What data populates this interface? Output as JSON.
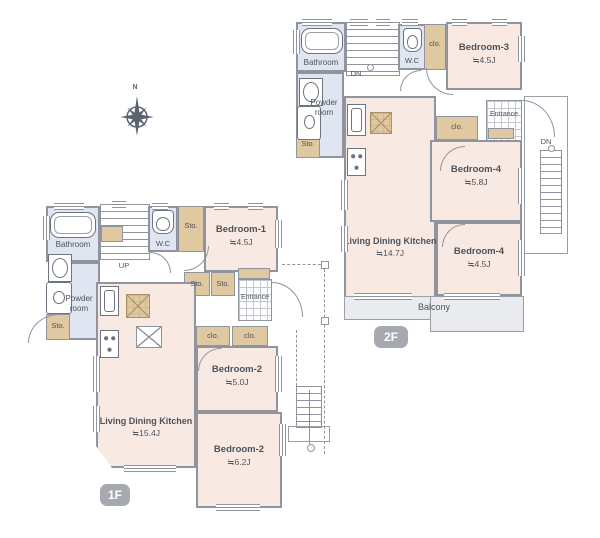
{
  "labels": {
    "bathroom": "Bathroom",
    "powder_room": "Powder room",
    "wc": "W.C",
    "sto": "Sto.",
    "clo": "clo.",
    "shoes_clo": "Shoes clo.",
    "entrance": "Entrance",
    "balcony": "Balcony",
    "up": "UP",
    "dn": "DN",
    "north": "N"
  },
  "floors": {
    "f1": {
      "badge": "1F",
      "ldk": {
        "name": "Living Dining Kitchen",
        "size": "≒15.4J"
      },
      "bedroom1": {
        "name": "Bedroom-1",
        "size": "≒4.5J"
      },
      "bedroom2a": {
        "name": "Bedroom-2",
        "size": "≒5.0J"
      },
      "bedroom2b": {
        "name": "Bedroom-2",
        "size": "≒6.2J"
      }
    },
    "f2": {
      "badge": "2F",
      "ldk": {
        "name": "Living Dining Kitchen",
        "size": "≒14.7J"
      },
      "bedroom3": {
        "name": "Bedroom-3",
        "size": "≒4.5J"
      },
      "bedroom4a": {
        "name": "Bedroom-4",
        "size": "≒5.8J"
      },
      "bedroom4b": {
        "name": "Bedroom-4",
        "size": "≒4.5J"
      }
    }
  },
  "colors": {
    "room": "#f8eae3",
    "wet_area": "#dfe6f2",
    "storage": "#e0c8a0",
    "wall": "#8f949e",
    "balcony": "#eaebee",
    "badge": "#a6aab0",
    "text": "#4c525c"
  }
}
